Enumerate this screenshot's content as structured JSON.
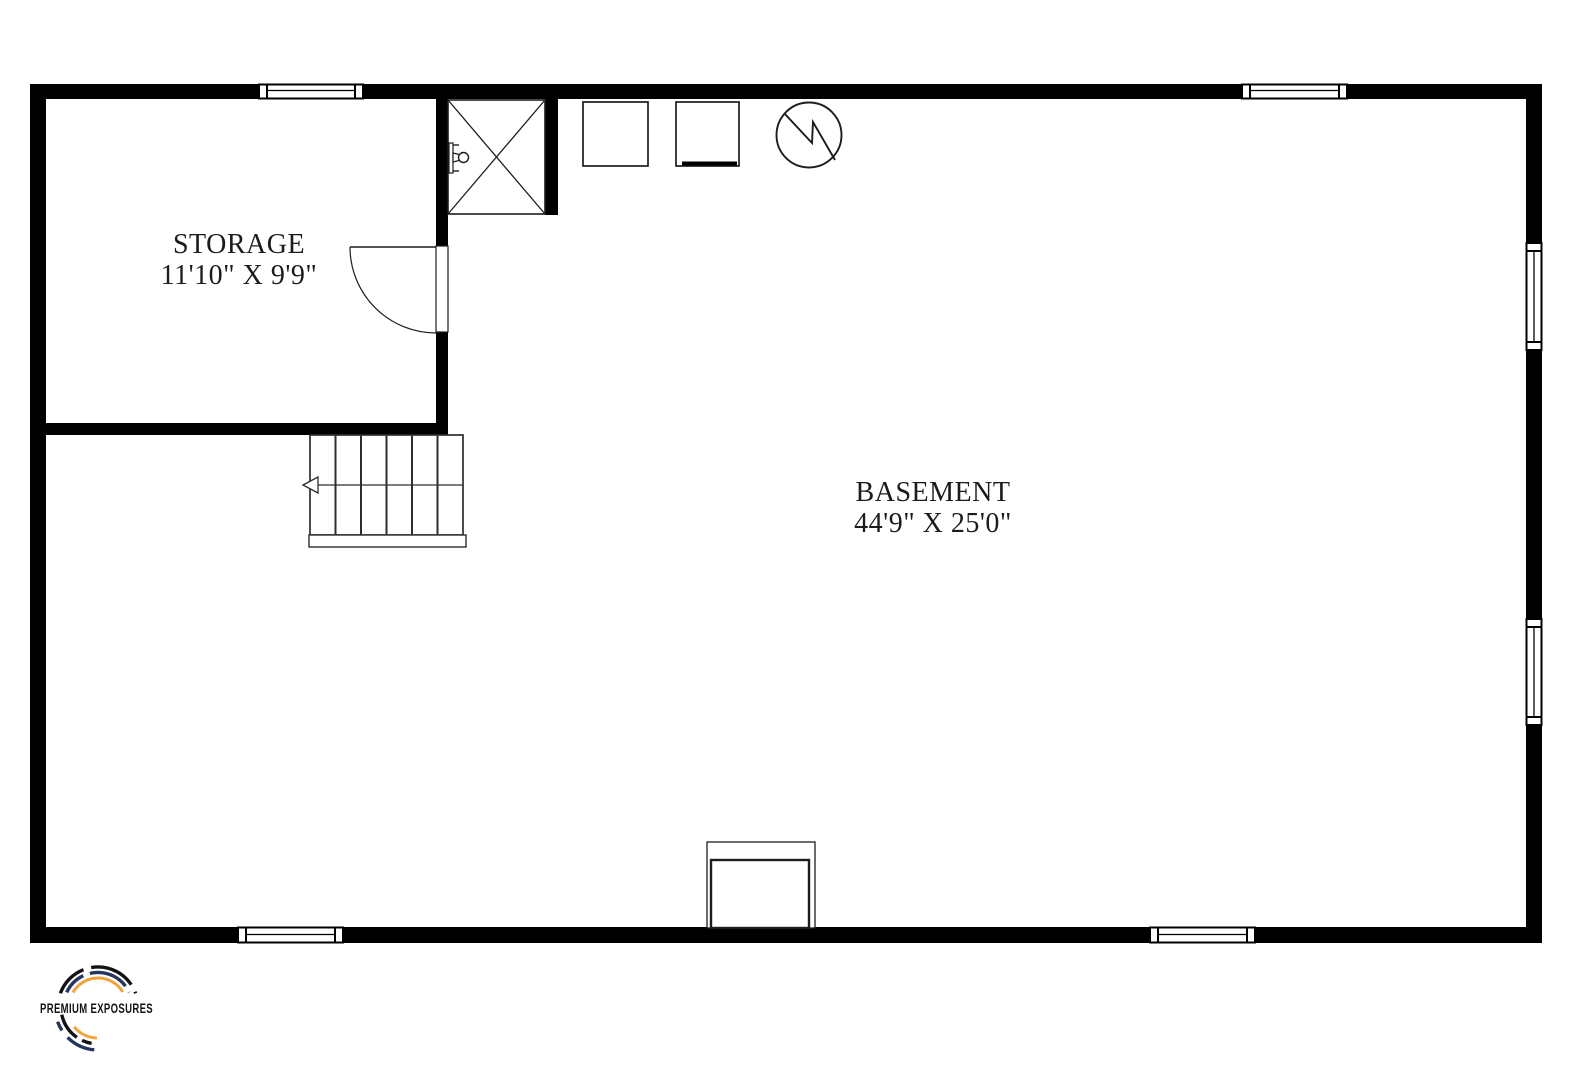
{
  "plan": {
    "rooms": [
      {
        "name": "STORAGE",
        "dimensions": "11'10\" X 9'9\""
      },
      {
        "name": "BASEMENT",
        "dimensions": "44'9\" X 25'0\""
      }
    ],
    "fixtures": [
      "shower",
      "washer",
      "dryer",
      "water-heater",
      "stairs",
      "door-swing",
      "fireplace"
    ],
    "window_count": 6,
    "colors": {
      "walls": "#000000",
      "lines": "#1d1d1d",
      "text": "#1c1c1c"
    }
  },
  "logo": {
    "text": "PREMIUM EXPOSURES",
    "colors": {
      "navy": "#24365e",
      "orange": "#f0a23c",
      "black": "#131313"
    }
  }
}
